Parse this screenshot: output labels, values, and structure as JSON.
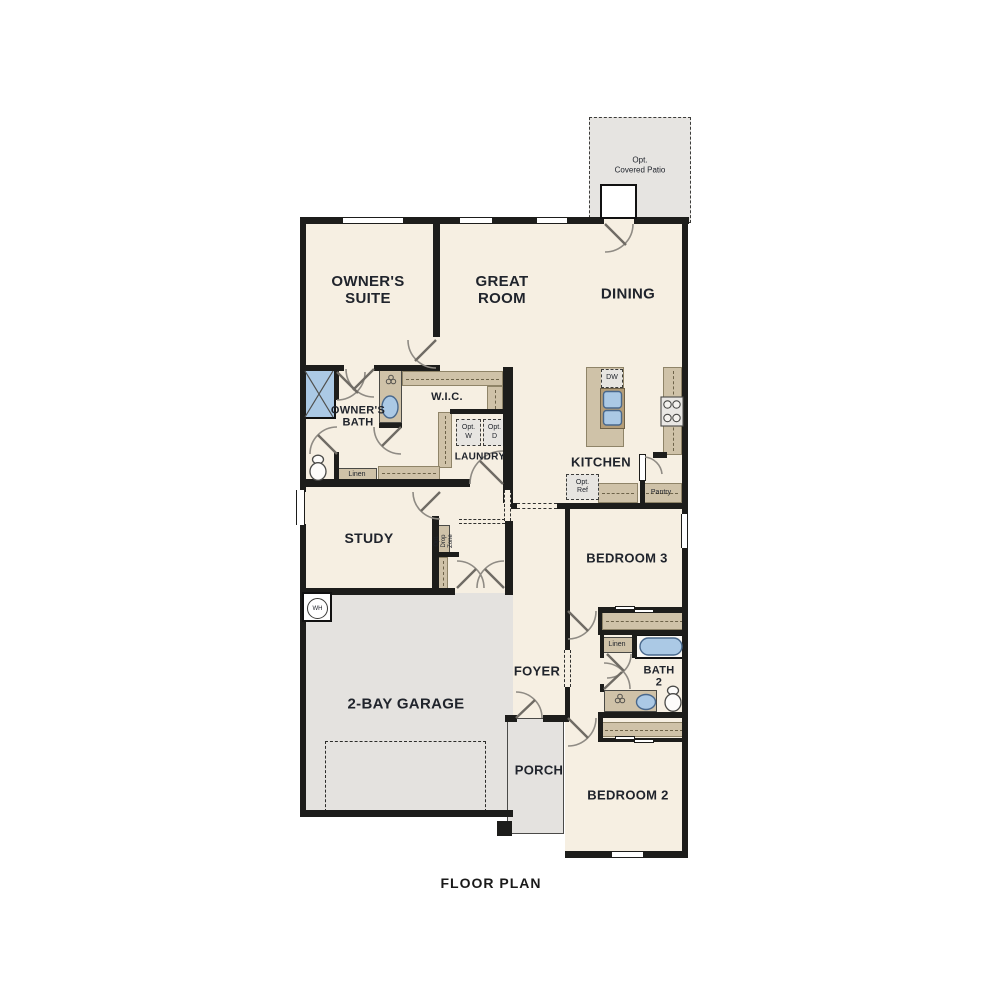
{
  "title": "FLOOR PLAN",
  "colors": {
    "floor": "#f6efe2",
    "hardscape": "#e4e2df",
    "cabinet_tan": "#cfc2a8",
    "wall_black": "#1d1d1b",
    "fixture_blue": "#abc9e5",
    "door_swing_gray": "#8f8b84",
    "text": "#20242c"
  },
  "labels": {
    "patio_line1": "Opt.",
    "patio_line2": "Covered Patio",
    "owners_suite_line1": "OWNER'S",
    "owners_suite_line2": "SUITE",
    "great_room_line1": "GREAT",
    "great_room_line2": "ROOM",
    "dining": "DINING",
    "owners_bath_line1": "OWNER'S",
    "owners_bath_line2": "BATH",
    "wic": "W.I.C.",
    "laundry": "LAUNDRY",
    "opt_w_line1": "Opt.",
    "opt_w_line2": "W",
    "opt_d_line1": "Opt.",
    "opt_d_line2": "D",
    "linen_owners": "Linen",
    "kitchen": "KITCHEN",
    "dw": "DW",
    "opt_ref_line1": "Opt.",
    "opt_ref_line2": "Ref",
    "pantry": "Pantry",
    "study": "STUDY",
    "drop_zone_line1": "Opt.",
    "drop_zone_line2": "Drop",
    "drop_zone_line3": "Zone",
    "wh": "WH",
    "garage": "2-BAY GARAGE",
    "foyer": "FOYER",
    "porch": "PORCH",
    "bedroom3": "BEDROOM 3",
    "linen_bath2": "Linen",
    "bath2_line1": "BATH",
    "bath2_line2": "2",
    "bedroom2": "BEDROOM 2",
    "floor_plan": "FLOOR PLAN"
  }
}
